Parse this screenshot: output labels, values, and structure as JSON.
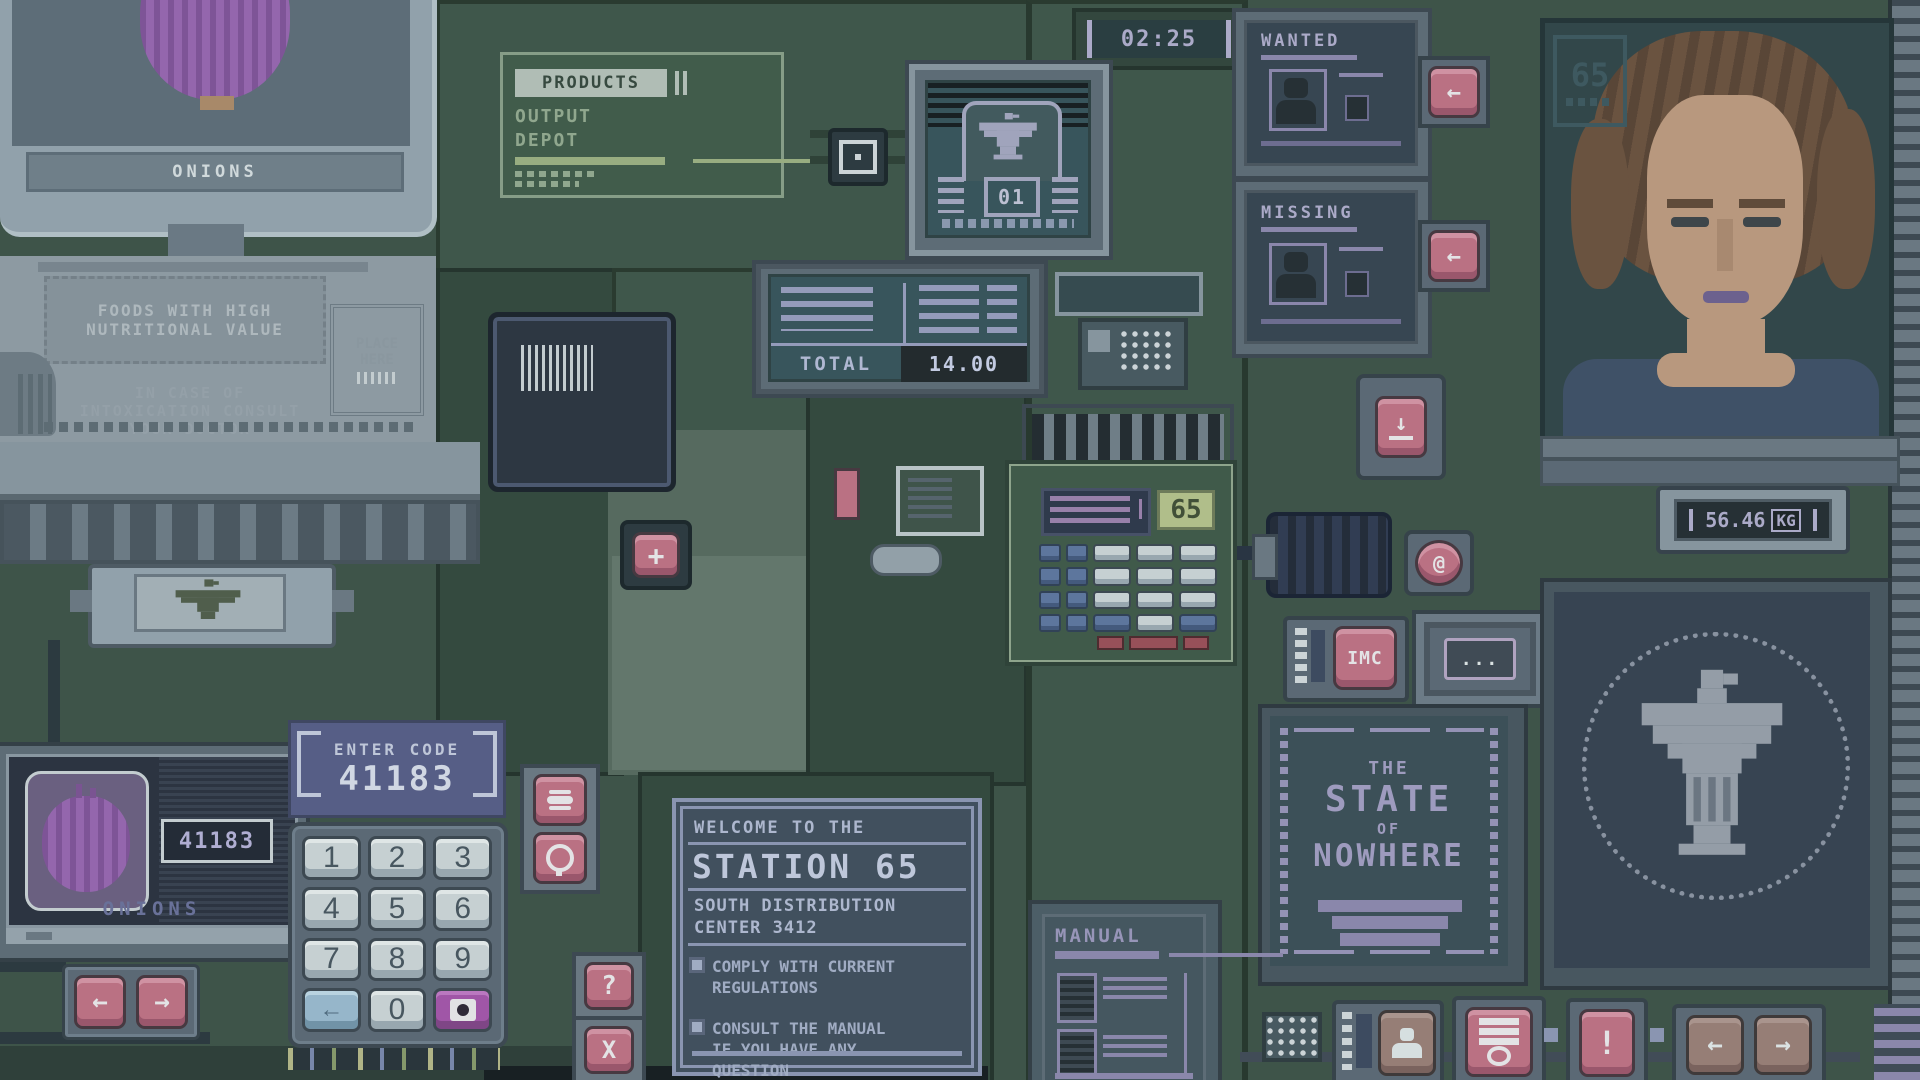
{
  "ui": {
    "product_monitor": {
      "label": "ONIONS"
    },
    "info_poster": {
      "headline": "FOODS WITH HIGH\nNUTRITIONAL VALUE",
      "body": "IN CASE OF\nINTOXICATION CONSULT\nYOUR DOCTOR",
      "place_here": "PLACE\nHERE"
    },
    "products_panel": {
      "title": "PRODUCTS",
      "subtitle": "OUTPUT\nDEPOT"
    },
    "clock": {
      "time": "02:25"
    },
    "emblem_screen": {
      "number": "01"
    },
    "pos_screen": {
      "total_label": "TOTAL",
      "total_value": "14.00"
    },
    "calculator": {
      "value": "65"
    },
    "wanted_poster": {
      "title": "WANTED"
    },
    "missing_poster": {
      "title": "MISSING"
    },
    "portrait": {
      "badge": "65"
    },
    "scale": {
      "weight": "56.46",
      "unit": "KG"
    },
    "state_poster": {
      "line1": "THE",
      "line2": "STATE",
      "line3": "OF",
      "line4": "NOWHERE"
    },
    "welcome_sign": {
      "intro": "WELCOME TO THE",
      "title": "STATION 65",
      "subtitle": "SOUTH DISTRIBUTION\nCENTER 3412",
      "bullet1": "COMPLY WITH CURRENT\nREGULATIONS",
      "bullet2": "CONSULT THE MANUAL\nIF YOU HAVE ANY\nQUESTION"
    },
    "manual_panel": {
      "title": "MANUAL"
    },
    "scanner_monitor": {
      "code": "41183",
      "label": "ONIONS"
    },
    "code_entry": {
      "prompt": "ENTER CODE",
      "value": "41183",
      "keys": [
        "1",
        "2",
        "3",
        "4",
        "5",
        "6",
        "7",
        "8",
        "9"
      ],
      "zero": "0"
    },
    "imc_button": {
      "label": "IMC"
    },
    "dots_display": {
      "value": "..."
    },
    "buttons": {
      "left_arrow": "←",
      "right_arrow": "→",
      "backspace": "←",
      "question": "?",
      "close": "X",
      "plus": "+",
      "alert": "!",
      "at": "@",
      "down": "↓"
    },
    "colors": {
      "machine_green": "#3a4e45",
      "panel_slate": "#5b6675",
      "button_pink": "#c56f85",
      "screen_navy": "#262b3b",
      "screen_teal": "#34505a",
      "text_lavender": "#b4aed2",
      "accent_magenta": "#a851ad",
      "key_blue": "#9cbcd4",
      "onion_purple": "#9a63b4",
      "display_olive": "#b9c48d"
    }
  }
}
